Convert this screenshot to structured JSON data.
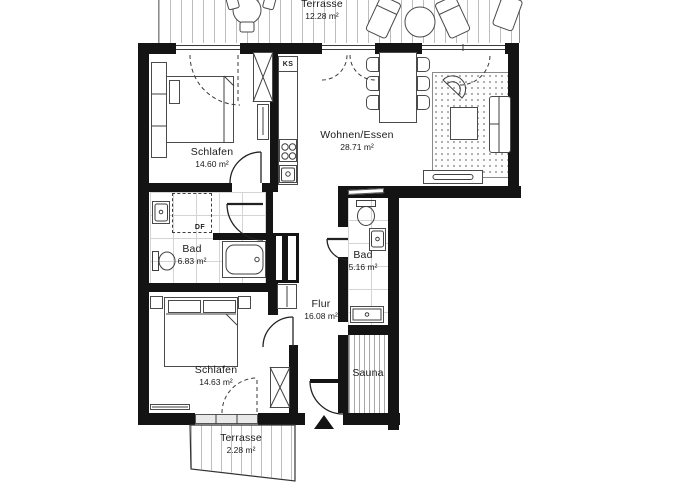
{
  "plan": {
    "title": "apartment-floor-plan",
    "colors": {
      "wall": "#141414",
      "line": "#4a4a4a",
      "tile_line": "#d4d4d4",
      "hatch": "#bdbdbd",
      "background": "#ffffff"
    },
    "rooms": [
      {
        "name": "Terrasse",
        "area": "12.28 m²"
      },
      {
        "name": "Schlafen",
        "area": "14.60 m²"
      },
      {
        "name": "Wohnen/Essen",
        "area": "28.71 m²"
      },
      {
        "name": "Bad",
        "area": "6.83 m²"
      },
      {
        "name": "Bad",
        "area": "5.16 m²"
      },
      {
        "name": "Flur",
        "area": "16.08 m²"
      },
      {
        "name": "Schlafen",
        "area": "14.63 m²"
      },
      {
        "name": "Sauna"
      },
      {
        "name": "Terrasse",
        "area": "2.28 m²"
      }
    ],
    "labels": {
      "fridge": "KS",
      "roof_window": "DF"
    }
  }
}
